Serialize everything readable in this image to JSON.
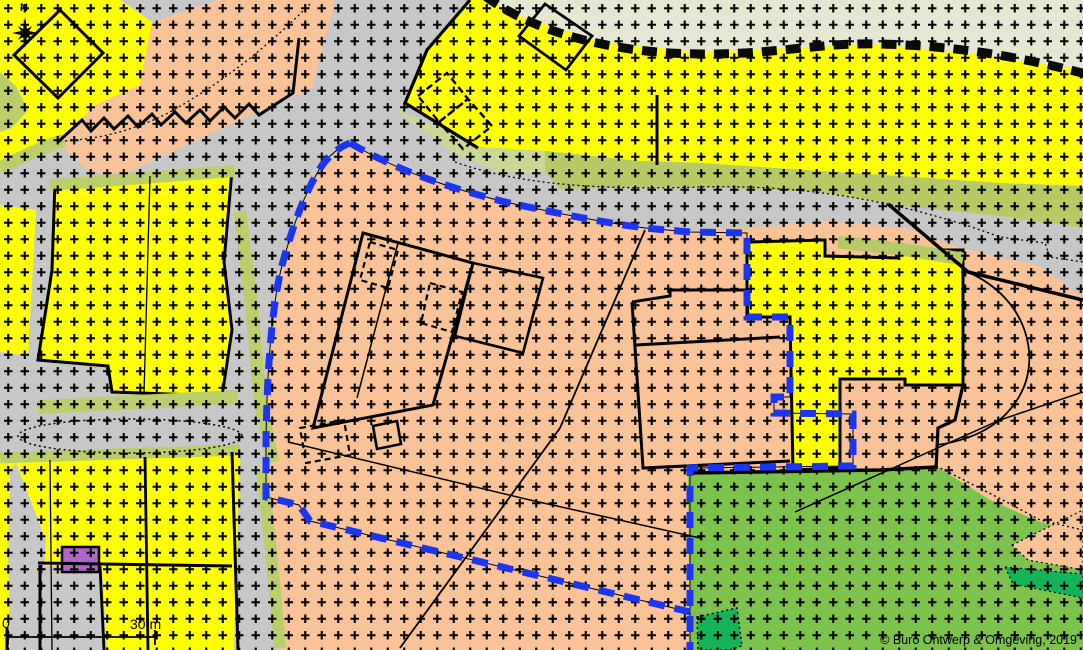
{
  "map": {
    "title": "Zoning plan map",
    "north_label": "N",
    "scale_bar": {
      "zero_label": "0",
      "distance_label": "30 m"
    },
    "copyright": "© Buro Ontwerp & Omgeving, 2019",
    "colors": {
      "road_grey": "#C7C7C7",
      "residential_yellow": "#FFFF00",
      "mixed_orange": "#F9C397",
      "verge_olive": "#B7CA66",
      "verge_light": "#CBD794",
      "beige_north": "#E5E7D3",
      "green_area": "#7CC34E",
      "bright_green": "#13B359",
      "purple_parcel": "#B164CB",
      "plan_boundary_blue": "#1B35F1",
      "line_black": "#000000"
    },
    "layers": [
      {
        "name": "base-road-grey",
        "kind": "rect",
        "attrs": {
          "x": 0,
          "y": 0,
          "width": 1083,
          "height": 650,
          "fill": "#C7C7C7"
        }
      },
      {
        "name": "zone-beige-northeast",
        "kind": "polygon",
        "attrs": {
          "points": "487,0 1083,0 1083,70 960,52 870,44 700,52 600,42 520,16",
          "fill": "#E5E7D3"
        }
      },
      {
        "name": "zone-yellow-north",
        "kind": "polygon",
        "attrs": {
          "points": "470,0 487,0 520,16 600,42 700,52 870,44 960,52 1083,70 1083,186 1000,183 900,176 820,171 700,163 640,161 545,151 478,147 445,130 405,103 427,50",
          "fill": "#FFFF00"
        }
      },
      {
        "name": "zone-yellow-topleft",
        "kind": "polygon",
        "attrs": {
          "points": "0,0 120,0 152,22 140,85 95,108 60,140 0,170",
          "fill": "#FFFF00"
        }
      },
      {
        "name": "zone-orange-topleft",
        "kind": "polygon",
        "attrs": {
          "points": "152,22 218,0 335,0 312,88 240,120 150,162 115,178 85,168 58,143 95,105 140,85",
          "fill": "#F9C397"
        }
      },
      {
        "name": "zone-yellow-west-parcel",
        "kind": "polygon",
        "attrs": {
          "points": "55,182 232,170 224,262 232,330 222,396 112,392 108,366 38,360 52,270",
          "fill": "#FFFF00",
          "stroke": "#000000",
          "stroke-width": 3
        }
      },
      {
        "name": "zone-yellow-west-sliver",
        "kind": "polygon",
        "attrs": {
          "points": "0,205 36,210 28,356 0,352",
          "fill": "#FFFF00"
        }
      },
      {
        "name": "zone-yellow-southwest",
        "kind": "polygon",
        "attrs": {
          "points": "0,461 240,452 234,650 0,650",
          "fill": "#FFFF00"
        }
      },
      {
        "name": "zone-orange-central",
        "kind": "polygon",
        "attrs": {
          "points": "266,497 266,430 272,330 284,258 295,228 315,177 350,143 420,178 505,202 610,224 690,231 760,227 830,221 905,228 960,248 1003,258 1040,266 1083,298 1083,532 1040,522 990,500 936,466 880,470 688,472 690,650 282,650 272,560",
          "fill": "#F9C397"
        }
      },
      {
        "name": "zone-green-southeast",
        "kind": "polygon",
        "attrs": {
          "points": "688,472 880,470 936,466 990,500 1040,522 1083,532 1083,650 690,650",
          "fill": "#7CC34E"
        }
      },
      {
        "name": "zone-orange-wedge-east",
        "kind": "polygon",
        "attrs": {
          "points": "1012,545 1083,510 1083,570 1028,560",
          "fill": "#F9C397",
          "stroke": "#000000",
          "stroke-width": 1.2,
          "stroke-dasharray": "2 3"
        }
      },
      {
        "name": "zone-brightgreen-band-east",
        "kind": "polygon",
        "attrs": {
          "points": "1005,567 1083,574 1083,598 1013,584",
          "fill": "#13B359",
          "stroke": "#000000",
          "stroke-width": 1.2,
          "stroke-dasharray": "2 3"
        }
      },
      {
        "name": "zone-brightgreen-patch-south",
        "kind": "polygon",
        "attrs": {
          "points": "697,617 737,608 742,646 730,650 698,650",
          "fill": "#13B359",
          "stroke": "#000000",
          "stroke-width": 1.5,
          "stroke-dasharray": "2 3"
        }
      },
      {
        "name": "road-branch-southwest",
        "kind": "polygon",
        "attrs": {
          "points": "16,463 46,540 44,566 102,567 107,650 10,650 8,560 10,470",
          "fill": "#C7C7C7"
        }
      },
      {
        "name": "zone-yellow-corner-sliver",
        "kind": "rect",
        "attrs": {
          "x": 0,
          "y": 600,
          "width": 9,
          "height": 50,
          "fill": "#FFFF00"
        }
      },
      {
        "name": "zone-yellow-east-parcel",
        "kind": "polygon",
        "attrs": {
          "points": "750,242 825,240 825,256 897,258 897,250 963,250 963,385 905,385 905,379 840,379 840,468 793,470 790,317 747,317 747,243",
          "fill": "#FFFF00",
          "stroke": "#000000",
          "stroke-width": 3
        }
      },
      {
        "name": "parcel-purple",
        "kind": "rect",
        "attrs": {
          "x": 62,
          "y": 547,
          "width": 37,
          "height": 25,
          "fill": "#B164CB",
          "stroke": "#000000",
          "stroke-width": 2.5
        }
      },
      {
        "name": "verge-strip-topleft",
        "kind": "path",
        "attrs": {
          "d": "M64,140 Q30,152 0,168",
          "fill": "none",
          "stroke": "#BCCE6C",
          "stroke-width": 13
        }
      },
      {
        "name": "verge-patch-left-edge",
        "kind": "polygon",
        "attrs": {
          "points": "0,72 16,86 28,110 12,128 0,132",
          "fill": "#BCCE6C"
        }
      },
      {
        "name": "verge-strip-west-upper",
        "kind": "path",
        "attrs": {
          "d": "M50,185 L235,171",
          "fill": "none",
          "stroke": "#BCCE6C",
          "stroke-width": 12
        }
      },
      {
        "name": "verge-strip-west-road",
        "kind": "path",
        "attrs": {
          "d": "M240,212 L252,310 L260,400 L273,462",
          "fill": "none",
          "stroke": "#BCCE6C",
          "stroke-width": 13
        }
      },
      {
        "name": "verge-strip-mid-road-north",
        "kind": "path",
        "attrs": {
          "d": "M38,407 L238,397",
          "fill": "none",
          "stroke": "#BCCE6C",
          "stroke-width": 14
        }
      },
      {
        "name": "verge-strip-mid-road-south",
        "kind": "path",
        "attrs": {
          "d": "M0,458 L240,450",
          "fill": "none",
          "stroke": "#BCCE6C",
          "stroke-width": 11
        }
      },
      {
        "name": "verge-strip-south-road",
        "kind": "path",
        "attrs": {
          "d": "M262,470 L272,560 L280,648",
          "fill": "none",
          "stroke": "#BCCE6C",
          "stroke-width": 12
        }
      },
      {
        "name": "verge-band-north-west",
        "kind": "polygon",
        "attrs": {
          "points": "392,108 445,130 478,147 545,151 545,172 500,173 452,152 408,120",
          "fill": "#CBD794"
        }
      },
      {
        "name": "verge-band-north-east",
        "kind": "polygon",
        "attrs": {
          "points": "545,151 640,161 700,163 820,171 900,176 1000,183 1083,186 1083,228 1000,216 905,206 820,192 700,187 640,187 560,189 545,172",
          "fill": "#B7CA66"
        }
      },
      {
        "name": "verge-strip-east-parcel",
        "kind": "path",
        "attrs": {
          "d": "M838,242 L900,249 L963,259",
          "fill": "none",
          "stroke": "#B7CA66",
          "stroke-width": 13
        }
      },
      {
        "name": "cross-hatch-overlay",
        "kind": "rect",
        "attrs": {
          "x": 0,
          "y": 0,
          "width": 1083,
          "height": 650,
          "fill": "pattern:crosses"
        }
      },
      {
        "name": "road-edge-dotted-topleft",
        "kind": "path",
        "attrs": {
          "d": "M310,4 Q245,70 170,112 Q120,138 64,141",
          "fill": "none",
          "stroke": "#000000",
          "stroke-width": 1.3,
          "stroke-dasharray": "2 3"
        }
      },
      {
        "name": "road-edge-dotted-north",
        "kind": "path",
        "attrs": {
          "d": "M455,162 C520,185 600,190 700,187 C800,184 900,200 1000,237 L1045,243 L1050,257 L1083,262",
          "fill": "none",
          "stroke": "#000000",
          "stroke-width": 1.3,
          "stroke-dasharray": "2 3"
        }
      },
      {
        "name": "roundabout-dotted",
        "kind": "ellipse",
        "attrs": {
          "cx": 130,
          "cy": 436,
          "rx": 112,
          "ry": 17,
          "fill": "none",
          "stroke": "#000000",
          "stroke-width": 1.5,
          "stroke-dasharray": "2 3"
        }
      },
      {
        "name": "building-diamond-topleft",
        "kind": "polygon",
        "attrs": {
          "points": "60,10 103,53 58,98 14,55",
          "fill": "none",
          "stroke": "#000000",
          "stroke-width": 3
        }
      },
      {
        "name": "building-zigzag-row",
        "kind": "polyline",
        "attrs": {
          "points": "58,142 82,120 91,131 104,118 114,129 128,116 138,127 152,114 161,125 175,112 186,123 200,110 210,121 224,107 235,118 249,104 259,115 293,93 299,38",
          "fill": "none",
          "stroke": "#000000",
          "stroke-width": 3
        }
      },
      {
        "name": "building-dashed-north-a",
        "kind": "polygon",
        "attrs": {
          "points": "418,96 447,73 468,99 439,122",
          "fill": "none",
          "stroke": "#000000",
          "stroke-width": 2.4,
          "stroke-dasharray": "7 4"
        }
      },
      {
        "name": "building-dashed-north-b",
        "kind": "polygon",
        "attrs": {
          "points": "439,122 468,99 492,126 463,149",
          "fill": "none",
          "stroke": "#000000",
          "stroke-width": 2.4,
          "stroke-dasharray": "7 4"
        }
      },
      {
        "name": "building-north-center",
        "kind": "polygon",
        "attrs": {
          "points": "545,4 592,36 566,70 519,36",
          "fill": "none",
          "stroke": "#000000",
          "stroke-width": 2.8
        }
      },
      {
        "name": "parcel-edge-yellow-north-west",
        "kind": "path",
        "attrs": {
          "d": "M470,0 L427,50 L405,103 L478,148",
          "fill": "none",
          "stroke": "#000000",
          "stroke-width": 3.2
        }
      },
      {
        "name": "parcel-divider-north",
        "kind": "line",
        "attrs": {
          "x1": 657,
          "y1": 95,
          "x2": 657,
          "y2": 165,
          "stroke": "#000000",
          "stroke-width": 3
        }
      },
      {
        "name": "farm-building-main",
        "kind": "polygon",
        "attrs": {
          "points": "363,233 473,263 433,405 313,428",
          "fill": "none",
          "stroke": "#000000",
          "stroke-width": 3
        }
      },
      {
        "name": "farm-building-annex",
        "kind": "polygon",
        "attrs": {
          "points": "473,263 543,278 523,353 455,336",
          "fill": "none",
          "stroke": "#000000",
          "stroke-width": 2.6
        }
      },
      {
        "name": "farm-building-inner-line",
        "kind": "line",
        "attrs": {
          "x1": 398,
          "y1": 243,
          "x2": 357,
          "y2": 398,
          "stroke": "#000000",
          "stroke-width": 1.5
        }
      },
      {
        "name": "farm-dashed-a",
        "kind": "polygon",
        "attrs": {
          "points": "370,242 398,250 388,288 360,280",
          "fill": "none",
          "stroke": "#000000",
          "stroke-width": 2.2,
          "stroke-dasharray": "6 4"
        }
      },
      {
        "name": "farm-dashed-b",
        "kind": "polygon",
        "attrs": {
          "points": "430,283 462,292 452,332 421,323",
          "fill": "none",
          "stroke": "#000000",
          "stroke-width": 2.2,
          "stroke-dasharray": "6 4"
        }
      },
      {
        "name": "farm-dashed-c",
        "kind": "polygon",
        "attrs": {
          "points": "300,428 344,420 350,455 306,463",
          "fill": "none",
          "stroke": "#000000",
          "stroke-width": 2.2,
          "stroke-dasharray": "6 4"
        }
      },
      {
        "name": "farm-shed-small",
        "kind": "polygon",
        "attrs": {
          "points": "373,426 397,421 401,444 377,449",
          "fill": "none",
          "stroke": "#000000",
          "stroke-width": 2.6
        }
      },
      {
        "name": "parcel-center-right",
        "kind": "path",
        "attrs": {
          "d": "M632,302 L670,296 L670,290 L746,290 L748,316 M632,302 L643,468 L790,461 M636,345 L780,337",
          "fill": "none",
          "stroke": "#000000",
          "stroke-width": 3
        }
      },
      {
        "name": "parcel-east-step-outline",
        "kind": "path",
        "attrs": {
          "d": "M963,385 L955,420 L938,428 L936,469",
          "fill": "none",
          "stroke": "#000000",
          "stroke-width": 3.2
        }
      },
      {
        "name": "green-top-edge-thick",
        "kind": "path",
        "attrs": {
          "d": "M688,473 L880,470 L936,467",
          "fill": "none",
          "stroke": "#000000",
          "stroke-width": 3.5
        }
      },
      {
        "name": "road-edge-thick-northeast",
        "kind": "path",
        "attrs": {
          "d": "M888,204 L968,272 L1083,300",
          "fill": "none",
          "stroke": "#000000",
          "stroke-width": 3.5
        }
      },
      {
        "name": "path-arc-east",
        "kind": "path",
        "attrs": {
          "d": "M968,272 C1030,300 1040,360 1020,395 C1000,432 960,442 936,445",
          "fill": "none",
          "stroke": "#000000",
          "stroke-width": 1.8
        }
      },
      {
        "name": "path-diagonal-long",
        "kind": "path",
        "attrs": {
          "d": "M645,230 L560,428 L400,648",
          "fill": "none",
          "stroke": "#000000",
          "stroke-width": 1.8
        }
      },
      {
        "name": "path-thin-south-a",
        "kind": "path",
        "attrs": {
          "d": "M288,442 L530,500 L700,538",
          "fill": "none",
          "stroke": "#000000",
          "stroke-width": 1.5
        }
      },
      {
        "name": "path-thin-south-b",
        "kind": "path",
        "attrs": {
          "d": "M795,512 L1000,420 L1083,392",
          "fill": "none",
          "stroke": "#000000",
          "stroke-width": 1.5
        }
      },
      {
        "name": "green-edge-dotted-east",
        "kind": "path",
        "attrs": {
          "d": "M936,466 Q1000,498 1040,520 L1083,530",
          "fill": "none",
          "stroke": "#000000",
          "stroke-width": 1.4,
          "stroke-dasharray": "2 3"
        }
      },
      {
        "name": "parcel-inner-line-west",
        "kind": "line",
        "attrs": {
          "x1": 150,
          "y1": 176,
          "x2": 144,
          "y2": 394,
          "stroke": "#000000",
          "stroke-width": 1.3
        }
      },
      {
        "name": "parcel-line-sw-1",
        "kind": "line",
        "attrs": {
          "x1": 50,
          "y1": 460,
          "x2": 52,
          "y2": 650,
          "stroke": "#000000",
          "stroke-width": 1.3
        }
      },
      {
        "name": "parcel-line-sw-2",
        "kind": "line",
        "attrs": {
          "x1": 145,
          "y1": 457,
          "x2": 148,
          "y2": 650,
          "stroke": "#000000",
          "stroke-width": 2.8
        }
      },
      {
        "name": "parcel-line-sw-3",
        "kind": "line",
        "attrs": {
          "x1": 232,
          "y1": 452,
          "x2": 238,
          "y2": 650,
          "stroke": "#000000",
          "stroke-width": 3
        }
      },
      {
        "name": "parcel-line-sw-4",
        "kind": "line",
        "attrs": {
          "x1": 38,
          "y1": 563,
          "x2": 232,
          "y2": 566,
          "stroke": "#000000",
          "stroke-width": 3
        }
      },
      {
        "name": "parcel-line-sw-5",
        "kind": "line",
        "attrs": {
          "x1": 100,
          "y1": 566,
          "x2": 104,
          "y2": 650,
          "stroke": "#000000",
          "stroke-width": 2.8
        }
      },
      {
        "name": "parcel-line-sw-6",
        "kind": "line",
        "attrs": {
          "x1": 40,
          "y1": 565,
          "x2": 40,
          "y2": 650,
          "stroke": "#000000",
          "stroke-width": 3
        }
      },
      {
        "name": "parcel-line-sw-7",
        "kind": "line",
        "attrs": {
          "x1": 7,
          "y1": 627,
          "x2": 7,
          "y2": 650,
          "stroke": "#000000",
          "stroke-width": 3
        }
      },
      {
        "name": "scalebar-line",
        "kind": "path",
        "attrs": {
          "d": "M8,630 L8,645 M8,637 L155,637 M155,630 L155,645",
          "fill": "none",
          "stroke": "#000000",
          "stroke-width": 1.8
        }
      },
      {
        "name": "municipal-boundary-dashed",
        "kind": "path",
        "attrs": {
          "d": "M485,-4 C525,26 590,48 670,53 C770,58 810,42 880,44 C960,46 1020,57 1086,74",
          "fill": "none",
          "stroke": "#0a0a0a",
          "stroke-width": 9,
          "stroke-dasharray": "15 9"
        }
      },
      {
        "name": "cadastral-line-under-boundary",
        "kind": "path",
        "attrs": {
          "d": "M350,143 C400,172 450,188 505,202 C560,214 615,225 655,229 L690,232 L747,233 L747,317 L790,317 L790,397 L774,397 L774,413 L853,414 L853,466 L690,468 L690,650 M690,612 L310,521 L299,505 L266,497 L266,440 C267,370 272,300 284,258 C292,230 302,200 315,177 C325,158 337,148 350,143",
          "fill": "none",
          "stroke": "#000000",
          "stroke-width": 1
        }
      },
      {
        "name": "plan-boundary-blue-dashed",
        "kind": "path",
        "attrs": {
          "d": "M350,143 C400,172 450,188 505,202 C560,214 615,225 655,229 L690,232 L747,233 L747,317 L790,317 L790,397 L774,397 L774,413 L853,414 L853,466 L690,468 L690,650 M690,612 L310,521 L299,505 L266,497 L266,440 C267,370 272,300 284,258 C292,230 302,200 315,177 C325,158 337,148 350,143",
          "fill": "none",
          "stroke": "#1B35F1",
          "stroke-width": 7,
          "stroke-dasharray": "16 10"
        }
      },
      {
        "name": "north-star",
        "kind": "polygon",
        "attrs": {
          "points": "25,17 27,29 32,26 29,31 38,33 29,35 32,40 27,37 25,48 23,37 18,40 21,35 12,33 21,31 18,26 23,29",
          "fill": "#000000"
        }
      }
    ]
  }
}
